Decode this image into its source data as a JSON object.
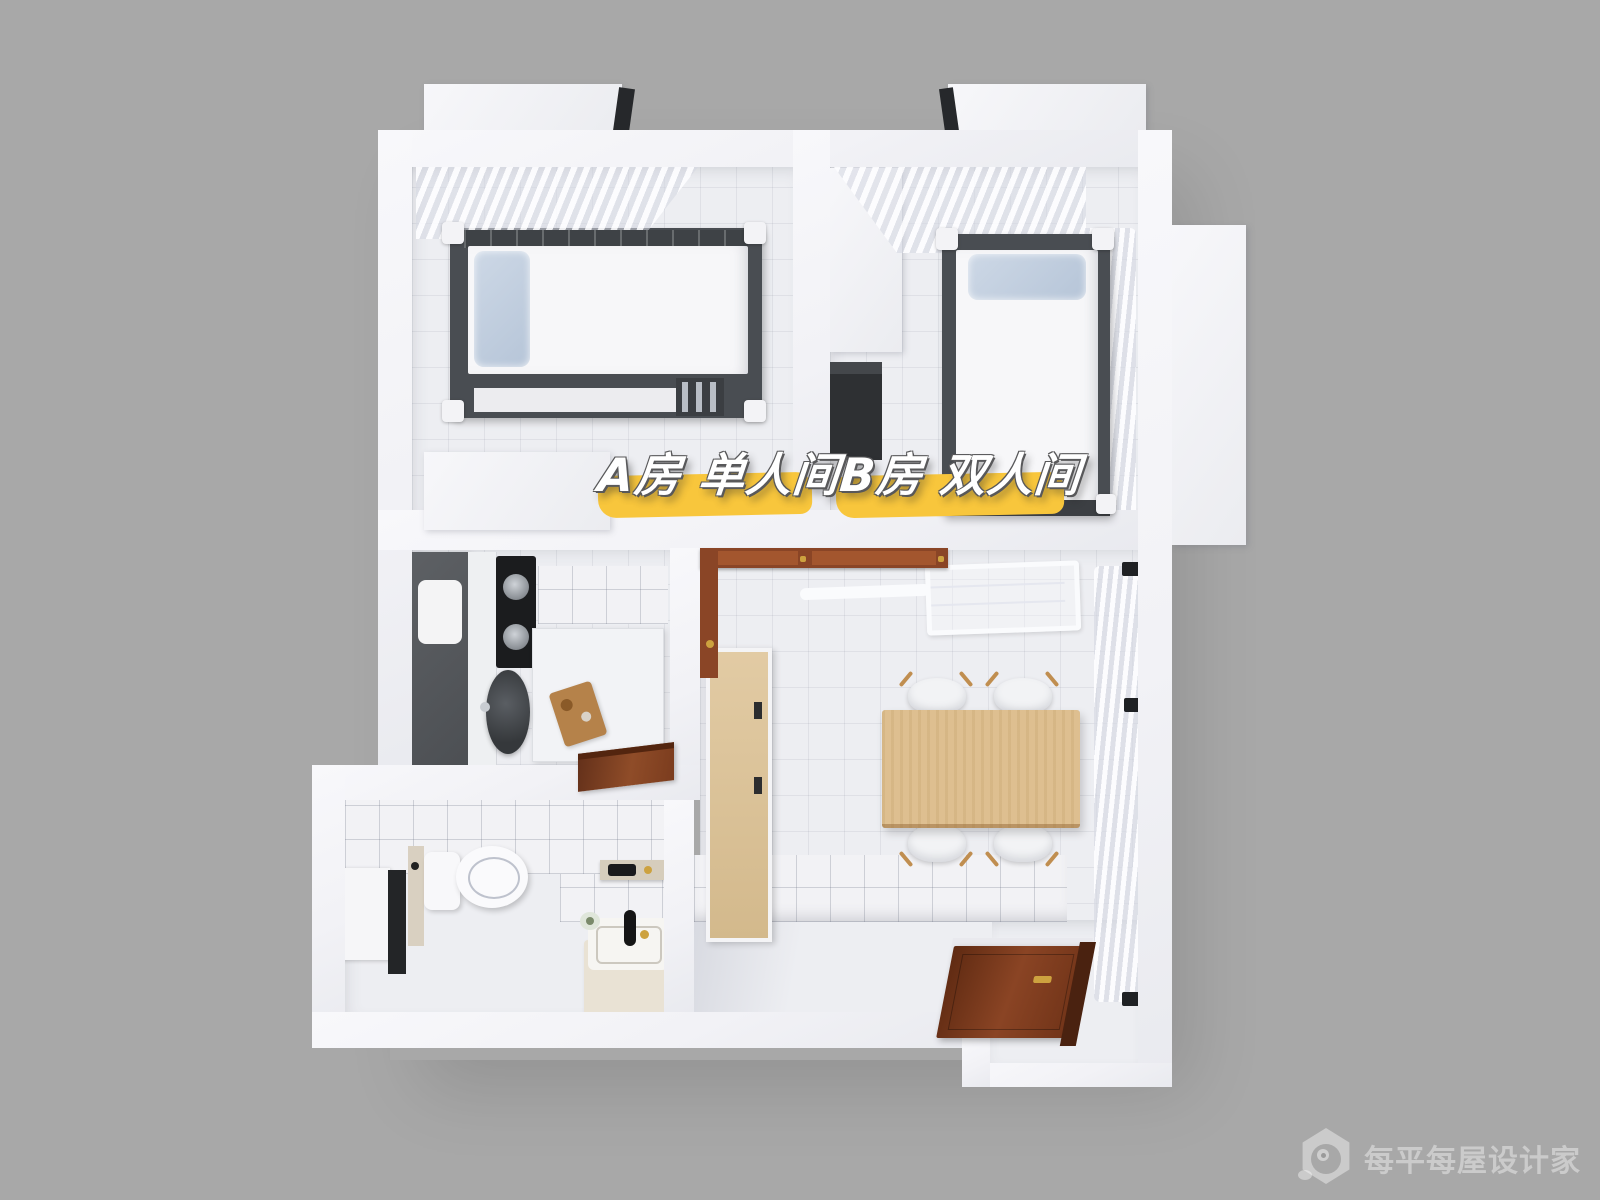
{
  "image": {
    "kind": "3d-floorplan-top-down-render",
    "width": 1600,
    "height": 1200,
    "background_color": "#a8a8a8"
  },
  "overlay": {
    "segments": [
      {
        "id": "room-a-label",
        "text": "A房 单人间"
      },
      {
        "id": "room-b-label",
        "text": "B房 双人间"
      }
    ],
    "text_color": "#ffffff",
    "highlight_color": "#f8c63c",
    "shadow_color": "#58585a"
  },
  "watermark": {
    "text": "每平每屋设计家",
    "logo": "hexagon-pet-logo",
    "color": "rgba(255,255,255,0.40)"
  },
  "palette": {
    "wall": "#f4f4f6",
    "floor": "#edeef2",
    "bed_frame": "#494d52",
    "mattress": "#f7f7f9",
    "pillow": "#c0cedf",
    "curtain": "#f4f5f8",
    "appliance_dark": "#54575b",
    "stove_black": "#1a1b1d",
    "sink_dark": "#3c3f42",
    "wood_door": "#8a4526",
    "entry_door_dark": "#5f2a12",
    "table_wood": "#debf90",
    "sideboard_wood": "#d9c09a",
    "chair_white": "#f2f3f5",
    "gold_hardware": "#cda23f",
    "basin_cream": "#e9e2d4",
    "faucet_black": "#151515"
  },
  "scene": {
    "rooms": [
      {
        "id": "bedroom-a",
        "items": [
          "window-curtain",
          "loft-bed",
          "pillow",
          "bed-ladder",
          "white-desk"
        ]
      },
      {
        "id": "bedroom-b",
        "items": [
          "window-curtain-top",
          "window-curtain-side",
          "white-wardrobe",
          "dark-desk",
          "single-bed",
          "pillow"
        ]
      },
      {
        "id": "kitchen",
        "items": [
          "tall-dark-cabinet",
          "gas-stove",
          "round-sink",
          "white-counter",
          "cutting-board",
          "wood-door"
        ]
      },
      {
        "id": "dining-room",
        "items": [
          "wood-door-frames",
          "drying-rack",
          "side-curtain",
          "wood-sideboard",
          "dining-table",
          "four-chairs",
          "entrance-door"
        ]
      },
      {
        "id": "bathroom",
        "items": [
          "window",
          "privacy-screen",
          "toilet",
          "wall-shelf",
          "washbasin",
          "flower-pot"
        ]
      }
    ],
    "exterior": [
      "window-box-top-left",
      "window-box-top-right",
      "window-box-right-side"
    ]
  }
}
